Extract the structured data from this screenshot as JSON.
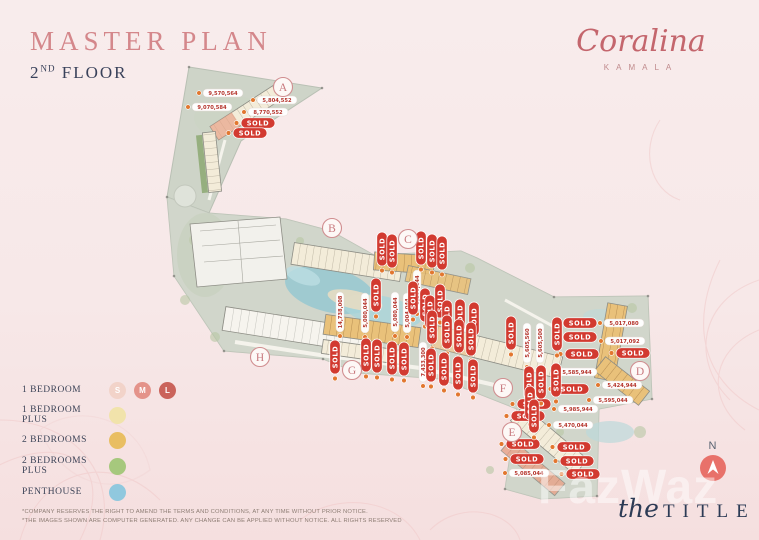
{
  "header": {
    "title": "MASTER PLAN",
    "floor_number": "2",
    "floor_ordinal": "ND",
    "floor_word": "FLOOR"
  },
  "brand": {
    "name": "Coralina",
    "location": "KAMALA"
  },
  "compass": {
    "label": "N"
  },
  "watermark": {
    "text": "FazWaz"
  },
  "footer_brand": {
    "script": "the",
    "caps": "TITLE"
  },
  "disclaimer": {
    "line1": "*COMPANY RESERVES THE RIGHT TO AMEND THE TERMS AND CONDITIONS, AT ANY TIME WITHOUT PRIOR NOTICE.",
    "line2": "*THE IMAGES SHOWN ARE COMPUTER GENERATED. ANY CHANGE CAN BE APPLIED WITHOUT NOTICE. ALL RIGHTS RESERVED"
  },
  "legend": {
    "items": [
      {
        "label": "1 BEDROOM",
        "swatches": [
          {
            "letter": "S",
            "color": "#f2d3c9"
          },
          {
            "letter": "M",
            "color": "#e4938a"
          },
          {
            "letter": "L",
            "color": "#ca635b"
          }
        ]
      },
      {
        "label": "1 BEDROOM PLUS",
        "swatches": [
          {
            "letter": "",
            "color": "#f1e3ab"
          }
        ]
      },
      {
        "label": "2 BEDROOMS",
        "swatches": [
          {
            "letter": "",
            "color": "#e9be62"
          }
        ]
      },
      {
        "label": "2 BEDROOMS PLUS",
        "swatches": [
          {
            "letter": "",
            "color": "#a6c87d"
          }
        ]
      },
      {
        "label": "PENTHOUSE",
        "swatches": [
          {
            "letter": "",
            "color": "#90c8de"
          }
        ]
      }
    ]
  },
  "plan": {
    "sold_label": "SOLD",
    "sections": [
      {
        "label": "A",
        "x": 283,
        "y": 87
      },
      {
        "label": "B",
        "x": 332,
        "y": 228
      },
      {
        "label": "C",
        "x": 408,
        "y": 239
      },
      {
        "label": "D",
        "x": 640,
        "y": 371
      },
      {
        "label": "E",
        "x": 512,
        "y": 432
      },
      {
        "label": "F",
        "x": 503,
        "y": 388
      },
      {
        "label": "G",
        "x": 352,
        "y": 370
      },
      {
        "label": "H",
        "x": 260,
        "y": 357
      }
    ],
    "sold_badges": [
      {
        "x": 258,
        "y": 123,
        "o": "h"
      },
      {
        "x": 250,
        "y": 133,
        "o": "h"
      },
      {
        "x": 580,
        "y": 323,
        "o": "h"
      },
      {
        "x": 580,
        "y": 337,
        "o": "h"
      },
      {
        "x": 582,
        "y": 354,
        "o": "h"
      },
      {
        "x": 633,
        "y": 353,
        "o": "h"
      },
      {
        "x": 572,
        "y": 389,
        "o": "h"
      },
      {
        "x": 534,
        "y": 404,
        "o": "h"
      },
      {
        "x": 528,
        "y": 416,
        "o": "h"
      },
      {
        "x": 523,
        "y": 444,
        "o": "h"
      },
      {
        "x": 574,
        "y": 447,
        "o": "h"
      },
      {
        "x": 527,
        "y": 459,
        "o": "h"
      },
      {
        "x": 577,
        "y": 461,
        "o": "h"
      },
      {
        "x": 583,
        "y": 474,
        "o": "h"
      },
      {
        "x": 382,
        "y": 249,
        "o": "v"
      },
      {
        "x": 392,
        "y": 251,
        "o": "v"
      },
      {
        "x": 421,
        "y": 248,
        "o": "v"
      },
      {
        "x": 432,
        "y": 251,
        "o": "v"
      },
      {
        "x": 442,
        "y": 253,
        "o": "v"
      },
      {
        "x": 376,
        "y": 295,
        "o": "v"
      },
      {
        "x": 413,
        "y": 298,
        "o": "v"
      },
      {
        "x": 425,
        "y": 305,
        "o": "v"
      },
      {
        "x": 335,
        "y": 357,
        "o": "v"
      },
      {
        "x": 366,
        "y": 355,
        "o": "v"
      },
      {
        "x": 377,
        "y": 356,
        "o": "v"
      },
      {
        "x": 392,
        "y": 358,
        "o": "v"
      },
      {
        "x": 404,
        "y": 359,
        "o": "v"
      },
      {
        "x": 430,
        "y": 312,
        "o": "v"
      },
      {
        "x": 440,
        "y": 301,
        "o": "v"
      },
      {
        "x": 447,
        "y": 317,
        "o": "v"
      },
      {
        "x": 460,
        "y": 316,
        "o": "v"
      },
      {
        "x": 474,
        "y": 319,
        "o": "v"
      },
      {
        "x": 432,
        "y": 327,
        "o": "v"
      },
      {
        "x": 447,
        "y": 332,
        "o": "v"
      },
      {
        "x": 459,
        "y": 336,
        "o": "v"
      },
      {
        "x": 471,
        "y": 339,
        "o": "v"
      },
      {
        "x": 431,
        "y": 365,
        "o": "v"
      },
      {
        "x": 444,
        "y": 369,
        "o": "v"
      },
      {
        "x": 458,
        "y": 373,
        "o": "v"
      },
      {
        "x": 473,
        "y": 376,
        "o": "v"
      },
      {
        "x": 511,
        "y": 333,
        "o": "v"
      },
      {
        "x": 557,
        "y": 334,
        "o": "v"
      },
      {
        "x": 529,
        "y": 383,
        "o": "v"
      },
      {
        "x": 541,
        "y": 382,
        "o": "v"
      },
      {
        "x": 556,
        "y": 380,
        "o": "v"
      },
      {
        "x": 530,
        "y": 403,
        "o": "v"
      },
      {
        "x": 534,
        "y": 416,
        "o": "v"
      }
    ],
    "price_labels": [
      {
        "value": "9,570,564",
        "x": 223,
        "y": 93,
        "o": "h"
      },
      {
        "value": "5,804,552",
        "x": 277,
        "y": 100,
        "o": "h"
      },
      {
        "value": "9,070,584",
        "x": 212,
        "y": 107,
        "o": "h"
      },
      {
        "value": "8,770,552",
        "x": 268,
        "y": 112,
        "o": "h"
      },
      {
        "value": "5,017,080",
        "x": 624,
        "y": 323,
        "o": "h"
      },
      {
        "value": "5,017,092",
        "x": 625,
        "y": 341,
        "o": "h"
      },
      {
        "value": "5,585,944",
        "x": 577,
        "y": 372,
        "o": "h"
      },
      {
        "value": "5,424,944",
        "x": 622,
        "y": 385,
        "o": "h"
      },
      {
        "value": "5,595,044",
        "x": 613,
        "y": 400,
        "o": "h"
      },
      {
        "value": "5,985,944",
        "x": 578,
        "y": 409,
        "o": "h"
      },
      {
        "value": "5,470,044",
        "x": 573,
        "y": 425,
        "o": "h"
      },
      {
        "value": "5,085,044",
        "x": 529,
        "y": 473,
        "o": "h"
      },
      {
        "value": "14,738,008",
        "x": 340,
        "y": 312,
        "o": "v"
      },
      {
        "value": "5,080,044",
        "x": 365,
        "y": 313,
        "o": "v"
      },
      {
        "value": "5,080,044",
        "x": 395,
        "y": 312,
        "o": "v"
      },
      {
        "value": "5,004,044",
        "x": 407,
        "y": 313,
        "o": "v"
      },
      {
        "value": "5,108,044",
        "x": 417,
        "y": 290,
        "o": "v"
      },
      {
        "value": "7,433,300",
        "x": 423,
        "y": 362,
        "o": "v"
      },
      {
        "value": "5,605,560",
        "x": 527,
        "y": 343,
        "o": "v"
      },
      {
        "value": "5,605,500",
        "x": 540,
        "y": 343,
        "o": "v"
      }
    ]
  },
  "colors": {
    "accent_rose": "#d4878b",
    "navy": "#39415a",
    "sold_red": "#d23a30",
    "price_red": "#b5342c",
    "unit_dot_orange": "#e2772f",
    "site_gray": "#ccd2c6",
    "pool_teal": "#8ec6d2"
  }
}
